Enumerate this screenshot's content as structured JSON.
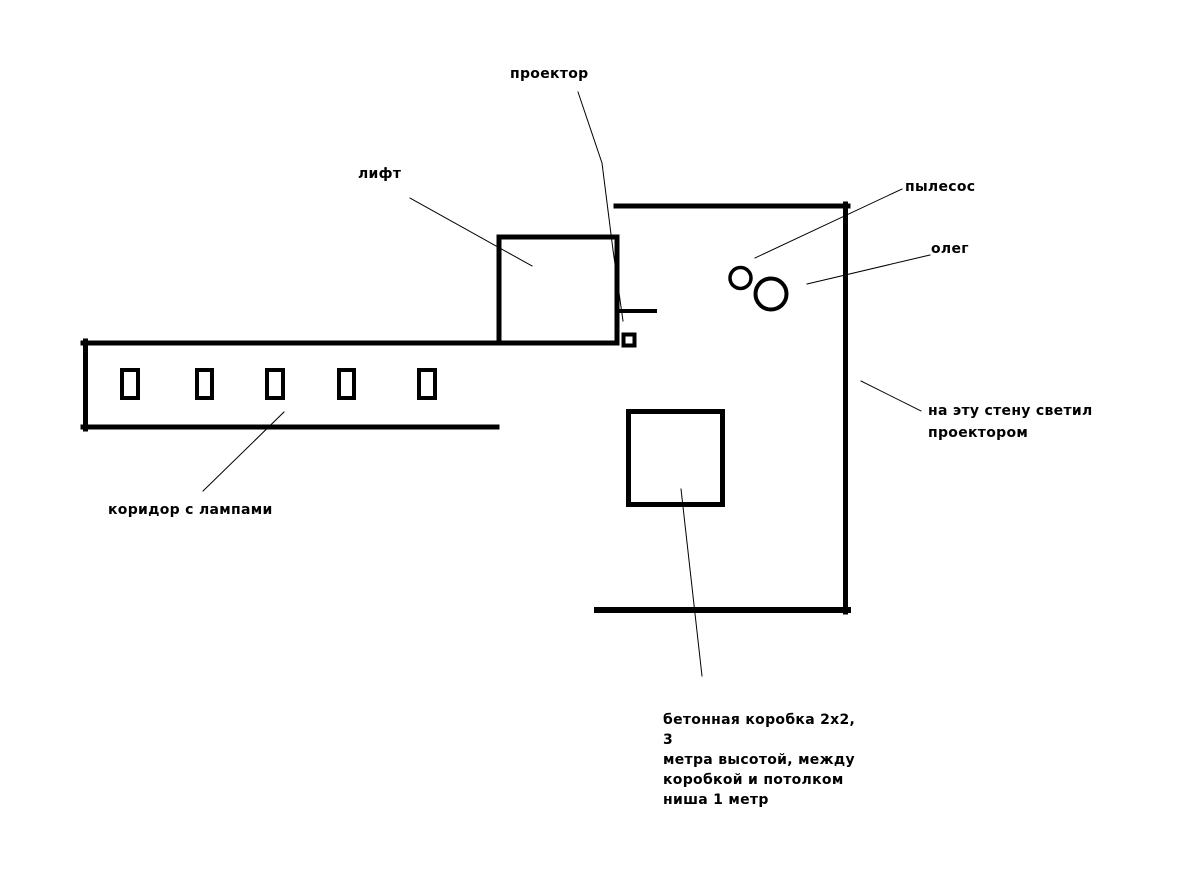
{
  "labels": {
    "projector": "проектор",
    "lift": "лифт",
    "vacuum": "пылесос",
    "oleg": "олег",
    "wall_note": "на эту стену светил\nпроектором",
    "corridor": "коридор с лампами",
    "box_note": "бетонная коробка 2х2, 3\nметра высотой, между\nкоробкой и потолком\nниша 1 метр"
  },
  "colors": {
    "ink": "#000000",
    "background": "#ffffff"
  }
}
